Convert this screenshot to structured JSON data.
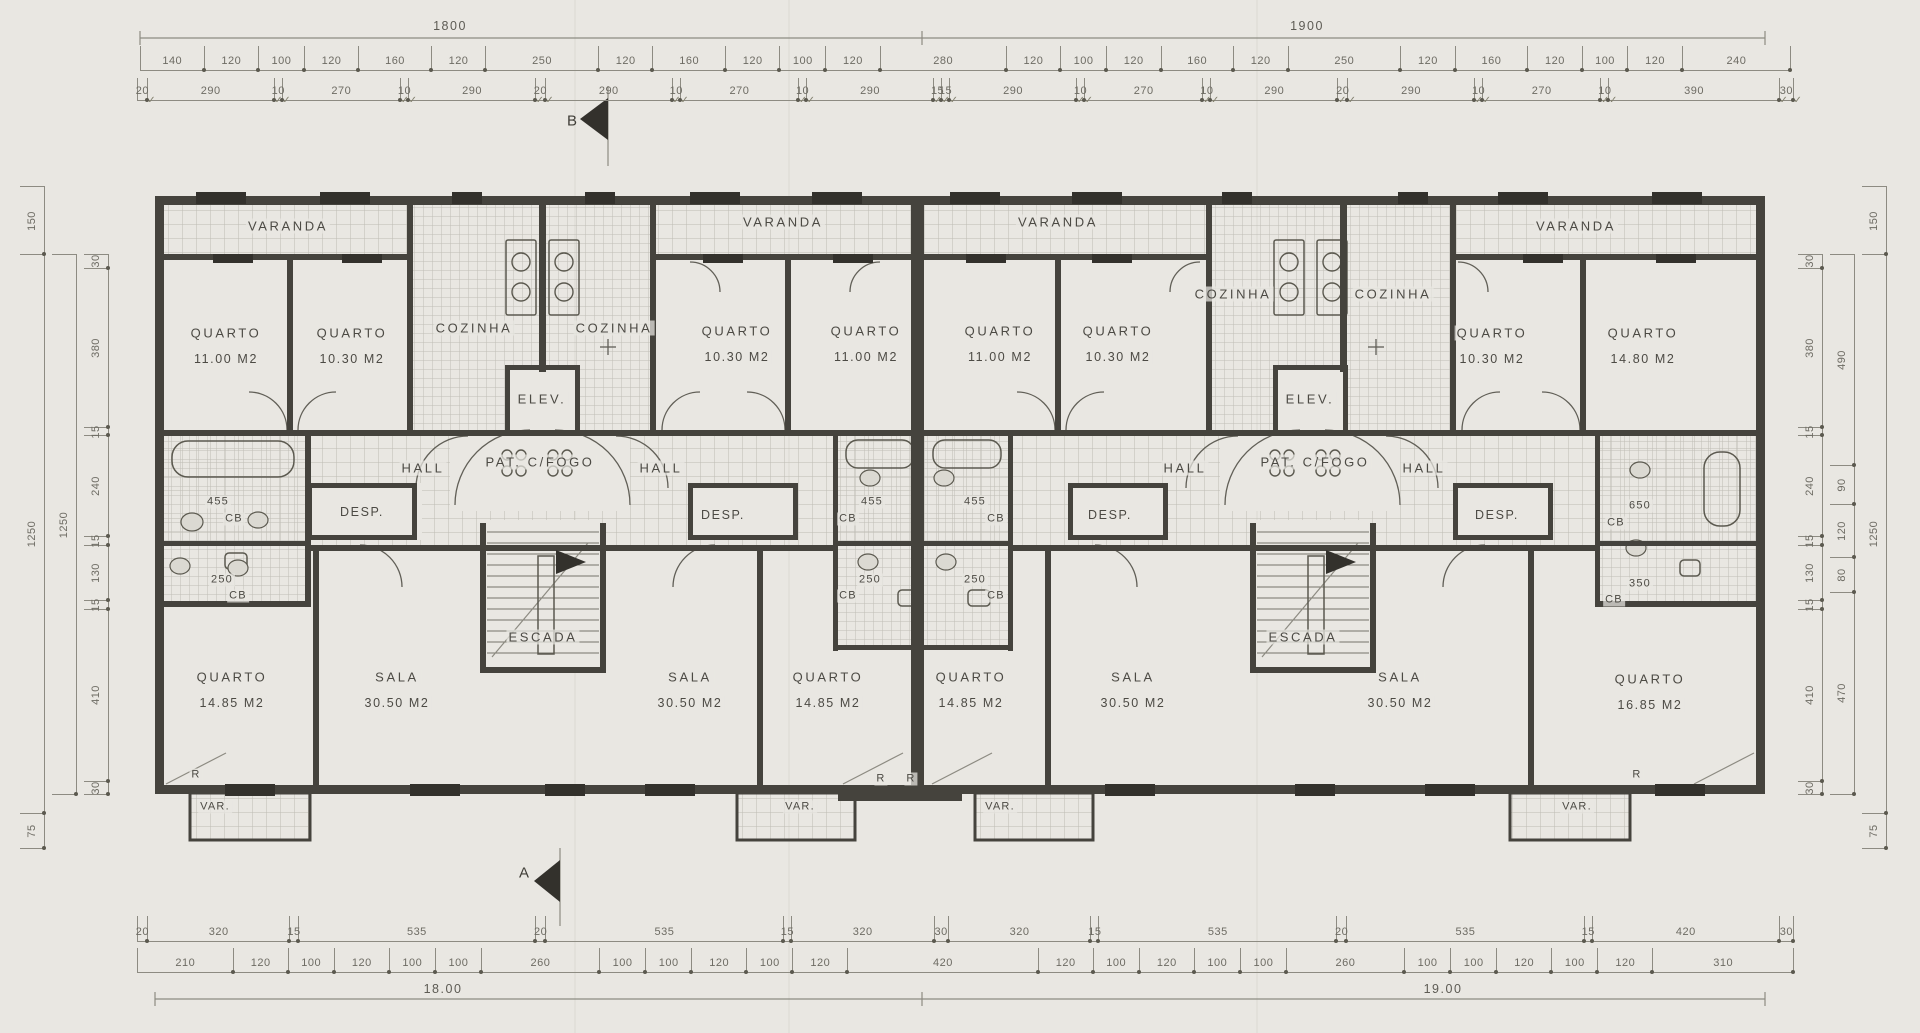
{
  "palette": {
    "paper": "#e9e7e2",
    "wall_ink": "#45433d",
    "thin_ink": "#8d8b82",
    "hatch": "#bdbbb3",
    "label_ink": "#4c4a44",
    "dim_ink": "#6d6b63"
  },
  "section_markers": {
    "top": "B",
    "bottom": "A"
  },
  "totals": {
    "top_left": "1800",
    "top_right": "1900",
    "bottom_left": "18.00",
    "bottom_right": "19.00"
  },
  "dims": {
    "top_segments": [
      "140",
      "120",
      "100",
      "120",
      "160",
      "120",
      "250",
      "120",
      "160",
      "120",
      "100",
      "120",
      "280",
      "120",
      "100",
      "120",
      "160",
      "120",
      "250",
      "120",
      "160",
      "120",
      "100",
      "120",
      "240"
    ],
    "top_detail": [
      "20",
      "290",
      "10",
      "270",
      "10",
      "290",
      "20",
      "290",
      "10",
      "270",
      "10",
      "290",
      "15",
      "15",
      "290",
      "10",
      "270",
      "10",
      "290",
      "20",
      "290",
      "10",
      "270",
      "10",
      "390",
      "30"
    ],
    "bottom_upper": [
      "20",
      "320",
      "15",
      "535",
      "20",
      "535",
      "15",
      "320",
      "30",
      "320",
      "15",
      "535",
      "20",
      "535",
      "15",
      "420",
      "30"
    ],
    "bottom_detail": [
      "210",
      "120",
      "100",
      "120",
      "100",
      "100",
      "260",
      "100",
      "100",
      "120",
      "100",
      "120",
      "420",
      "120",
      "100",
      "120",
      "100",
      "100",
      "260",
      "100",
      "100",
      "120",
      "100",
      "120",
      "310"
    ],
    "left_inner": [
      "30",
      "380",
      "15",
      "240",
      "15",
      "130",
      "15",
      "410",
      "30"
    ],
    "left_mid": [
      "1250"
    ],
    "left_outer": [
      "150",
      "1250",
      "75"
    ],
    "right_inner": [
      "30",
      "380",
      "15",
      "240",
      "15",
      "130",
      "15",
      "410",
      "30"
    ],
    "right_mid": [
      "490",
      "90",
      "120",
      "80",
      "470"
    ],
    "right_outer": [
      "150",
      "1250",
      "75"
    ]
  },
  "labels": {
    "varanda_l1": {
      "l1": "VARANDA"
    },
    "varanda_l2": {
      "l1": "VARANDA"
    },
    "varanda_r1": {
      "l1": "VARANDA"
    },
    "varanda_r2": {
      "l1": "VARANDA"
    },
    "quarto_l1a": {
      "l1": "QUARTO",
      "l2": "11.00 M2"
    },
    "quarto_l1b": {
      "l1": "QUARTO",
      "l2": "10.30 M2"
    },
    "quarto_l2a": {
      "l1": "QUARTO",
      "l2": "10.30 M2"
    },
    "quarto_l2b": {
      "l1": "QUARTO",
      "l2": "11.00 M2"
    },
    "quarto_r1a": {
      "l1": "QUARTO",
      "l2": "11.00 M2"
    },
    "quarto_r1b": {
      "l1": "QUARTO",
      "l2": "10.30 M2"
    },
    "quarto_r2a": {
      "l1": "QUARTO",
      "l2": "10.30 M2"
    },
    "quarto_r2b": {
      "l1": "QUARTO",
      "l2": "14.80 M2"
    },
    "cozinha_l1": {
      "l1": "COZINHA"
    },
    "cozinha_l2": {
      "l1": "COZINHA"
    },
    "cozinha_r1": {
      "l1": "COZINHA"
    },
    "cozinha_r2": {
      "l1": "COZINHA"
    },
    "elev_l": {
      "l1": "ELEV."
    },
    "elev_r": {
      "l1": "ELEV."
    },
    "pat_l": {
      "l1": "PAT. C/FOGO"
    },
    "pat_r": {
      "l1": "PAT. C/FOGO"
    },
    "hall_l1": {
      "l1": "HALL"
    },
    "hall_l2": {
      "l1": "HALL"
    },
    "hall_r1": {
      "l1": "HALL"
    },
    "hall_r2": {
      "l1": "HALL"
    },
    "cb455_l1": {
      "l1": "455",
      "l2": "CB"
    },
    "cb250_l1": {
      "l1": "250",
      "l2": "CB"
    },
    "cb455_c1": {
      "l1": "455",
      "l2": "CB"
    },
    "cb455_c2": {
      "l1": "455",
      "l2": "CB"
    },
    "cb250_c1": {
      "l1": "250",
      "l2": "CB"
    },
    "cb250_c2": {
      "l1": "250",
      "l2": "CB"
    },
    "cb650_r": {
      "l1": "650",
      "l2": "CB"
    },
    "cb350_r": {
      "l1": "350",
      "l2": "CB"
    },
    "desp_l1": {
      "l1": "DESP."
    },
    "desp_l2": {
      "l1": "DESP."
    },
    "desp_r1": {
      "l1": "DESP."
    },
    "desp_r2": {
      "l1": "DESP."
    },
    "escada_l": {
      "l1": "ESCADA"
    },
    "escada_r": {
      "l1": "ESCADA"
    },
    "quarto_l1c": {
      "l1": "QUARTO",
      "l2": "14.85 M2"
    },
    "sala_l1": {
      "l1": "SALA",
      "l2": "30.50 M2"
    },
    "sala_l2": {
      "l1": "SALA",
      "l2": "30.50 M2"
    },
    "quarto_l2c": {
      "l1": "QUARTO",
      "l2": "14.85 M2"
    },
    "quarto_r1c": {
      "l1": "QUARTO",
      "l2": "14.85 M2"
    },
    "sala_r1": {
      "l1": "SALA",
      "l2": "30.50 M2"
    },
    "sala_r2": {
      "l1": "SALA",
      "l2": "30.50 M2"
    },
    "quarto_r2c": {
      "l1": "QUARTO",
      "l2": "16.85 M2"
    },
    "var_l1": {
      "l1": "VAR."
    },
    "var_l2": {
      "l1": "VAR."
    },
    "var_r1": {
      "l1": "VAR."
    },
    "var_r2": {
      "l1": "VAR."
    },
    "r_l1": {
      "l1": "R"
    },
    "r_c1": {
      "l1": "R"
    },
    "r_c2": {
      "l1": "R"
    },
    "r_r2": {
      "l1": "R"
    },
    "marker_b": {
      "l1": "B"
    },
    "marker_a": {
      "l1": "A"
    },
    "total_top_left": {
      "l1": "1800"
    },
    "total_top_right": {
      "l1": "1900"
    },
    "total_bottom_left": {
      "l1": "18.00"
    },
    "total_bottom_right": {
      "l1": "19.00"
    }
  }
}
